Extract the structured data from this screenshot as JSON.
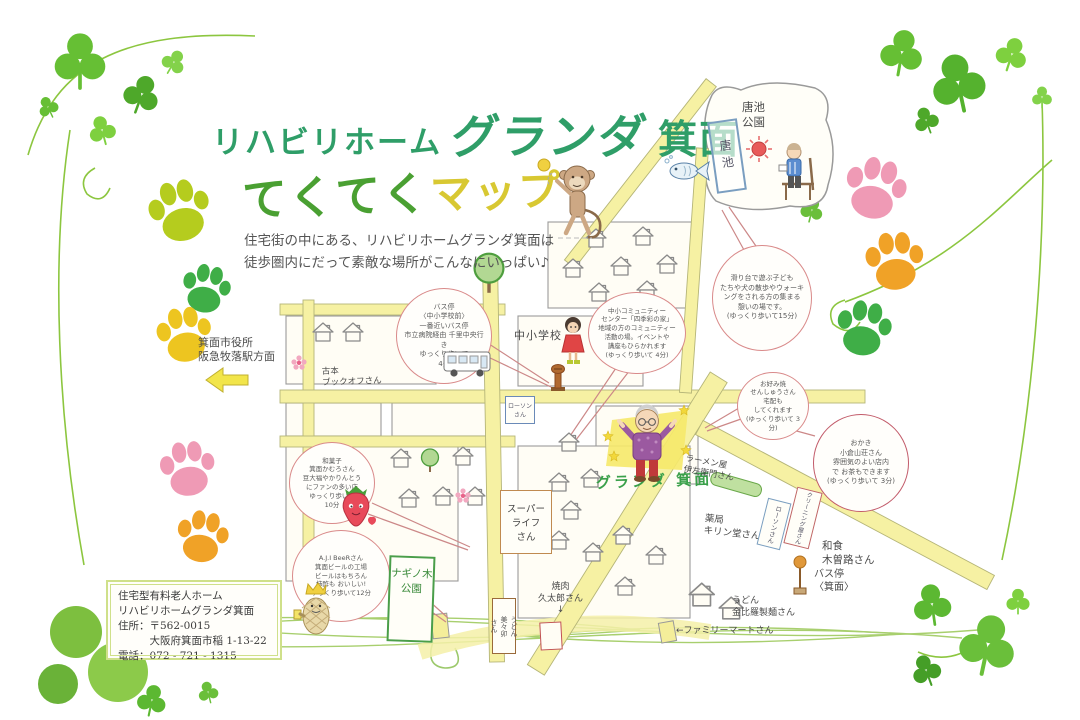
{
  "header": {
    "title_prefix": "リハビリホーム",
    "title_brand": "グランダ",
    "title_suffix": "箕面",
    "logo_tekuteku": "てくてく",
    "logo_map": "マップ",
    "subtitle": "住宅街の中にある、リハビリホームグランダ箕面は\n徒歩圏内にだって素敵な場所がこんなにいっぱい♪"
  },
  "bubbles": {
    "bus": "バス停\n〈中小学校前〉\n一番近いバス停\n市立病院経由 千里中央行き\nゆっくり歩いて\n4分",
    "community": "中小コミュニティー\nセンター「四季彩の家」\n地域の方のコミュニティー\n活動の場。イベントや\n講座もひらかれます\n(ゆっくり歩いて 4分)",
    "park": "滑り台で遊ぶ子ども\nたちや犬の散歩やウォーキ\nングをされる方の集まる\n憩いの場です。\n(ゆっくり歩いて15分)",
    "okonomiyaki": "お好み焼\nせんしゅうさん\n宅配も\nしてくれます\n(ゆっくり歩いて 3分)",
    "okaki": "おかき\n小倉山荘さん\n雰囲気のよい店内\nで お茶もできます\n(ゆっくり歩いて 3分)",
    "wagashi": "和菓子\n箕面かむろさん\n豆大福やかりんとう\nにファンの多い店\nゆっくり歩いて\n10分",
    "beer": "A.J.I BeeRさん\n箕面ビールの工場\nビールはもちろん\n柿酢も おいしい!\nゆっくり歩いて12分"
  },
  "labels": {
    "karaike_park": "唐池\n公園",
    "karaike_pond": "唐池",
    "city_hall": "箕面市役所\n阪急牧落駅方面",
    "bookoff": "古本\nブックオフさん",
    "school": "中小学校",
    "lawson_center": "ローソン\nさん",
    "super_life": "スーパー\nライフ\nさん",
    "granda": "グランダ 箕面",
    "ramen": "ラーメン屋\n伊左衛門さん",
    "pharmacy": "薬局\nキリン堂さん",
    "lawson_right": "ローソンさん",
    "cleaning": "クリーニング屋さん",
    "kisoji": "和食\n木曽路さん",
    "bus_stop_minoh": "バス停\n〈箕面〉",
    "konpira": "うどん\n金比羅製麺さん",
    "familymart": "←ファミリーマートさん",
    "mimiu": "うどん\n美々卯\nさん",
    "kyutaro": "焼肉\n久太郎さん\n↓",
    "naginoki_park": "ナギノ木\n公園"
  },
  "info_box": {
    "line1": "住宅型有料老人ホーム",
    "line2": "リハビリホームグランダ箕面",
    "line3": "住所：〒562-0015",
    "line4": "　　　大阪府箕面市稲 1-13-22",
    "line5": "電話：072 - 721 - 1315"
  },
  "colors": {
    "title_green": "#2f9e68",
    "logo_green": "#4aa032",
    "logo_yellow": "#d8c832",
    "road_yellow": "#f6f1a3",
    "bubble_border_pink": "#d98a8a",
    "bubble_border_red": "#c25b6a",
    "paw_pink": "#ef9ab5",
    "paw_orange": "#f0a227",
    "paw_green": "#3fae47",
    "paw_yellowgreen": "#b5cc1e",
    "paw_yellow": "#edc520",
    "clover_green": "#66bf34"
  }
}
